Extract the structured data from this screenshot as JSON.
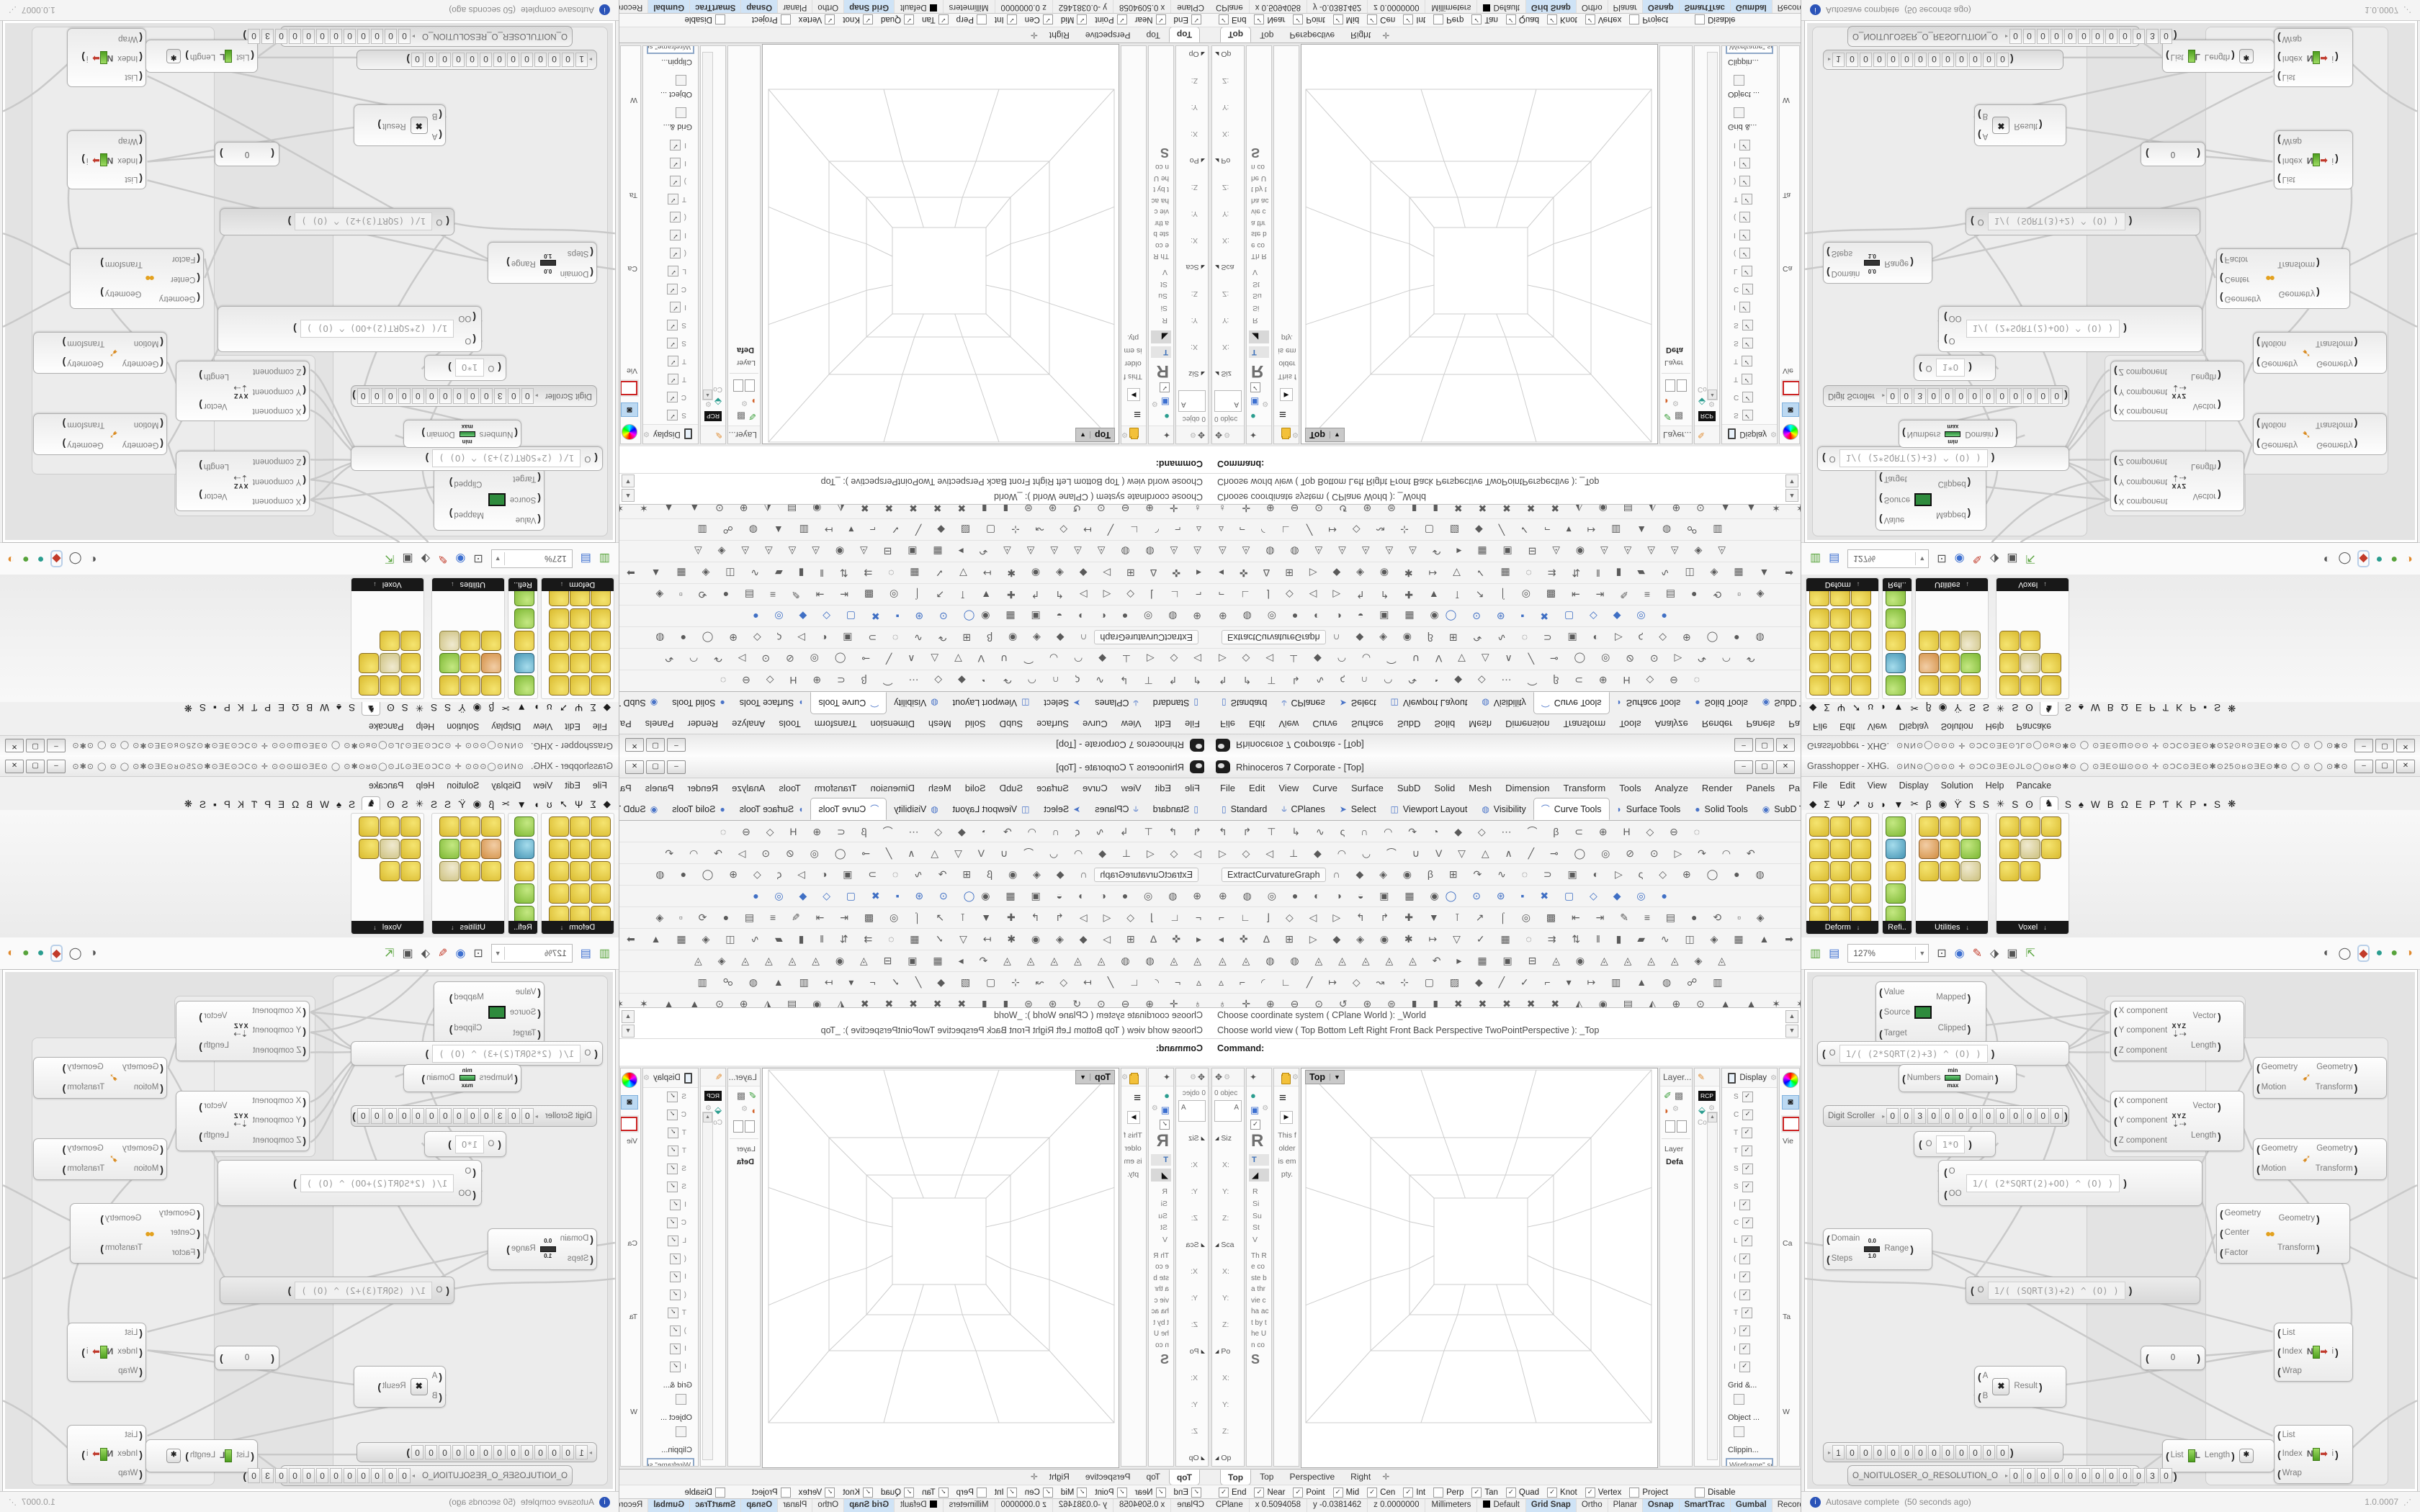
{
  "window": {
    "minimize": "–",
    "maximize": "▢",
    "close": "✕"
  },
  "rhino": {
    "title": "Rhinoceros 7 Corporate - [Top]",
    "menu": [
      "File",
      "Edit",
      "View",
      "Curve",
      "Surface",
      "SubD",
      "Solid",
      "Mesh",
      "Dimension",
      "Transform",
      "Tools",
      "Analyze",
      "Render",
      "Panels",
      "Paneling Tools",
      "Help"
    ],
    "toolbar_tabs": [
      {
        "icon": "▯",
        "label": "Standard",
        "active": false
      },
      {
        "icon": "⫝",
        "label": "CPlanes",
        "active": false
      },
      {
        "icon": "➤",
        "label": "Select",
        "active": false
      },
      {
        "icon": "◫",
        "label": "Viewport Layout",
        "active": false
      },
      {
        "icon": "◍",
        "label": "Visibility",
        "active": false
      },
      {
        "icon": "⌒",
        "label": "Curve Tools",
        "active": true
      },
      {
        "icon": "◗",
        "label": "Surface Tools",
        "active": false
      },
      {
        "icon": "●",
        "label": "Solid Tools",
        "active": false
      },
      {
        "icon": "◉",
        "label": "SubD Too",
        "active": false
      }
    ],
    "toolbar_overflow": "»",
    "toolbar_gear": "⚙",
    "extract_button": "ExtractCurvatureGraph",
    "toolbar_rows": {
      "r1": "↰ ↱ ⊤ ↳ ∿ ς ∩ ◠ ↷ ◔ ◆ ◇ ⋯ ⌒ β ⊂ ⊕ H ◇ ⊖ ◌",
      "r2": "▷ ◇ ◁ ⊥ ◆ ◠ ◡ ⌒ ∪ V ▽ △ ∧ ╱ ⊸ ◯ ◎ ⊘ ⊙ ▷ ↷ ◠ ↶",
      "r3": "∩ ◆ ◈ ◉ β ⊞ ↷ ∿ ◌ ⊃ ▣ ◐ ▷ ς ◇ ⊕ ◯ ● ◍",
      "r4a": "⊕ ◍ ◎ ● ◐ ◑ ◒ ▣ ▦ ◉",
      "r4b": "◯ ⊙ ⊛ ▪ ✖ ▢ ◇ ◆ ◎ ●",
      "r5": "⌐ ∟ ⌋ ◇ ◁ ▷ ↰ ↱ ✚ ▼ ⊺ ↗ ⌠ ◎ ▩ ⇤ ⇥ ✎ ≡ ▤ ● ⟲ ▫ ◈",
      "r6": "◂ ✜ Δ ⊞ ▷ ◆ ◈ ◉ ✱ ↦ ▽ ✓ ▦ ◌ ⇉ ⇅ ‖ ▮ ▰ ∿ ◫ ◈ ▦ ▲ ➡",
      "r7": "◬ ◬ ◍ ◍ ◬ ◬ ◬ ◬ ◬ ↶ ▸ ▦ ▣ ⊟ ◬ ◉ ◬ ◬ ◬ ◬ ◈ ◬",
      "r8": "▵ ⌐ ◜ ∟ ╱ ↦ ◇ ↝ ⊹ ▢ ▨ ◆ ╱ ✓ ⌐ ▾ ↦ ▥ ▲ ◍ ☍ ▥",
      "nav": "♁ ✛ ⊕ ⊖ ⊙ ↺ ⊛ ⊜ ▮ ▮ ✖ ✖ ✖ ✖ ✖ ◭ ◉ ▤ ◭ ⊕ ⊙ ▲ ▲ ✶ ✶ ◇ ◇ ↻ ✜ ✳ ◎"
    },
    "command_history": [
      "Choose coordinate system ( CPlane  World ): _World",
      "Choose world view ( Top  Bottom  Left  Right  Front  Back  Perspective  TwoPointPerspective ): _Top"
    ],
    "command_prompt": "Command:",
    "left_panels": {
      "boxedit_header": "0 objec",
      "boxedit_field": "A",
      "boxedit_rows": [
        {
          "t": "Siz",
          "h": true
        },
        {
          "t": "X:"
        },
        {
          "t": "Y:"
        },
        {
          "t": "Z:"
        },
        {
          "t": "Sca",
          "h": true
        },
        {
          "t": "X:"
        },
        {
          "t": "Y:"
        },
        {
          "t": "Z:"
        },
        {
          "t": "Po",
          "h": true
        },
        {
          "t": "X:"
        },
        {
          "t": "Y:"
        },
        {
          "t": "Z:"
        },
        {
          "t": "Op",
          "h": true
        },
        {
          "t": "Up",
          "h": true
        }
      ],
      "learn_big": "R",
      "learn_tab": "T",
      "learn_list": [
        "R",
        "Si",
        "Su",
        "St",
        "V"
      ],
      "learn_para": "Th Re co ste ba thr vie cha act by the Un co",
      "learn_heading": "S",
      "folder_empty": "This folder is empty."
    },
    "viewport_label": "Top",
    "viewport_tabs": [
      {
        "label": "Top",
        "active": true
      },
      {
        "label": "Top",
        "active": false
      },
      {
        "label": "Perspective",
        "active": false
      },
      {
        "label": "Right",
        "active": false
      }
    ],
    "viewport_add_tab": "✛",
    "right_panels": {
      "layer_tab": "Layer...",
      "layer_label": "Layer",
      "layer_value": "Defa",
      "rcp": "RCP",
      "co_label": "Co",
      "display_tab": "Display",
      "display_rows": [
        {
          "l": "S",
          "on": true
        },
        {
          "l": "C",
          "on": true
        },
        {
          "l": "T",
          "on": true
        },
        {
          "l": "T",
          "on": true
        },
        {
          "l": "S",
          "on": true
        },
        {
          "l": "S",
          "on": true
        },
        {
          "l": "I",
          "on": true
        },
        {
          "l": "C",
          "on": true
        },
        {
          "l": "L",
          "on": true
        },
        {
          "l": "(",
          "on": true
        },
        {
          "l": "I",
          "on": true
        },
        {
          "l": "(",
          "on": true
        },
        {
          "l": "T",
          "on": true
        },
        {
          "l": ")",
          "on": true
        },
        {
          "l": "I",
          "on": true
        },
        {
          "l": "I",
          "on": true
        }
      ],
      "grid_hdr": "Grid &...",
      "object_hdr": "Object ...",
      "clip_hdr": "Clippin...",
      "display_dropdown": "Wireframe\" set",
      "vie": "Vie",
      "ca": "Ca",
      "ta": "Ta",
      "wi": "W",
      "op": "Op"
    },
    "osnap": [
      {
        "label": "End",
        "on": true
      },
      {
        "label": "Near",
        "on": true
      },
      {
        "label": "Point",
        "on": true
      },
      {
        "label": "Mid",
        "on": true
      },
      {
        "label": "Cen",
        "on": true
      },
      {
        "label": "Int",
        "on": true
      },
      {
        "label": "Perp",
        "on": false
      },
      {
        "label": "Tan",
        "on": true
      },
      {
        "label": "Quad",
        "on": true
      },
      {
        "label": "Knot",
        "on": true
      },
      {
        "label": "Vertex",
        "on": true
      },
      {
        "label": "Project",
        "on": false
      }
    ],
    "osnap_disable": "Disable",
    "status_cells": [
      "CPlane",
      "x 0.5094058",
      "y -0.0381462",
      "z 0.0000000",
      "Millimeters"
    ],
    "status_layer": "Default",
    "status_toggles": [
      {
        "label": "Grid Snap",
        "on": true
      },
      {
        "label": "Ortho",
        "on": false
      },
      {
        "label": "Planar",
        "on": false
      },
      {
        "label": "Osnap",
        "on": true
      },
      {
        "label": "SmartTrac",
        "on": true
      },
      {
        "label": "Gumbal",
        "on": true
      },
      {
        "label": "Record History",
        "on": false
      },
      {
        "label": "Filter",
        "on": false
      }
    ]
  },
  "gh": {
    "title": "Grasshopper - XHG.",
    "title_glyphs": "⊙ИN⊙◯⊙⊙⊙ ✛ ⊙ƆC⊙ƎE⊙JL⊙◯⊙ʁ⊙✱⊙    ◯    ⊙ƎE⊙Ш⊙⊙⊙ ✛ ⊙ƆC⊙ƎE⊙✱⊙25⊙ʁ⊙ƎE⊙✱⊙    ◯    ⊙    ◯    ⊙✱⊙ƎE⊙ʁ⊙25⊙✱…",
    "menu": [
      "File",
      "Edit",
      "View",
      "Display",
      "Solution",
      "Help",
      "Pancake"
    ],
    "tabs": [
      {
        "g": "◆",
        "active": false
      },
      {
        "g": "Σ",
        "active": false
      },
      {
        "g": "Ψ",
        "active": false
      },
      {
        "g": "➚",
        "active": false
      },
      {
        "g": "ʊ",
        "active": false
      },
      {
        "g": "◗",
        "active": false
      },
      {
        "g": "▼",
        "active": false
      },
      {
        "g": "✂",
        "active": false
      },
      {
        "g": "β",
        "active": false
      },
      {
        "g": "◉",
        "active": false
      },
      {
        "g": "ϔ",
        "active": false
      },
      {
        "g": "S",
        "active": false
      },
      {
        "g": "S",
        "active": false
      },
      {
        "g": "✳",
        "active": false
      },
      {
        "g": "S",
        "active": false
      },
      {
        "g": "ʘ",
        "active": false
      },
      {
        "g": "♞",
        "active": true
      },
      {
        "g": "S",
        "active": false
      },
      {
        "g": "♠",
        "active": false
      },
      {
        "g": "W",
        "active": false
      },
      {
        "g": "B",
        "active": false
      },
      {
        "g": "Ω",
        "active": false
      },
      {
        "g": "E",
        "active": false
      },
      {
        "g": "P",
        "active": false
      },
      {
        "g": "Ƭ",
        "active": false
      },
      {
        "g": "K",
        "active": false
      },
      {
        "g": "P",
        "active": false
      },
      {
        "g": "▪",
        "active": false
      },
      {
        "g": "S",
        "active": false
      },
      {
        "g": "❋",
        "active": false
      }
    ],
    "ribbon": {
      "deform": {
        "label": "Deform",
        "cells": [
          "y",
          "y",
          "y",
          "y",
          "y",
          "y",
          "y",
          "y",
          "y",
          "y",
          "y",
          "y",
          "y",
          "y",
          "y"
        ]
      },
      "refine": {
        "label": "Refi..",
        "cells": [
          "g",
          "b",
          "y",
          "g",
          "g"
        ]
      },
      "utilities": {
        "label": "Utilities",
        "cells": [
          "y",
          "y",
          "y",
          "p",
          "y",
          "g",
          "y",
          "y",
          "k"
        ]
      },
      "voxel": {
        "label": "Voxel",
        "cells": [
          "y",
          "y",
          "y",
          "y",
          "k",
          "y",
          "y",
          "y"
        ]
      },
      "caption_arrow": "↓"
    },
    "toolbar_zoom": "127%",
    "statusbar": {
      "autosave": "Autosave complete",
      "ago": "(50 seconds ago)",
      "info": "i",
      "version": "1.0.0007",
      "grip": "⋰"
    },
    "nodes": {
      "remap": {
        "inputs": [
          "Value",
          "Source",
          "Target"
        ],
        "outputs": [
          "Mapped",
          "Clipped"
        ]
      },
      "expr1": {
        "var": "O",
        "formula": "1/( (2*SQRT(2)+3) ^ (O) )"
      },
      "bounds": {
        "inputs": [
          "Numbers"
        ],
        "outputs": [
          "Domain"
        ],
        "min": "min",
        "max": "max"
      },
      "scroller1": {
        "label": "Digit Scroller",
        "digits": [
          "0",
          "0",
          "3",
          "0",
          "0",
          "0",
          "0",
          "0",
          "0",
          "0",
          "0",
          "0",
          "0"
        ]
      },
      "exprsmall": {
        "var": "O",
        "formula": "1*O"
      },
      "vector": {
        "inputs": [
          "X component",
          "Y component",
          "Z component"
        ],
        "outputs": [
          "Vector",
          "Length"
        ],
        "icon": "XYZ"
      },
      "move": {
        "inputs": [
          "Geometry",
          "Motion"
        ],
        "outputs": [
          "Geometry",
          "Transform"
        ],
        "icon": "➹"
      },
      "expr2": {
        "var1": "O",
        "var2": "OO",
        "formula": "1/( (2*SQRT(2)+OO) ^ (O) )"
      },
      "range": {
        "inputs": [
          "Domain",
          "Steps"
        ],
        "outputs": [
          "Range"
        ],
        "min": "0.0",
        "max": "1.0"
      },
      "scale": {
        "inputs": [
          "Geometry",
          "Center",
          "Factor"
        ],
        "outputs": [
          "Geometry",
          "Transform"
        ],
        "icon": "●●"
      },
      "expr3": {
        "var": "O",
        "formula": "1/( (SQRT(3)+2) ^ (O) )"
      },
      "mult": {
        "inputs": [
          "A",
          "B"
        ],
        "outputs": [
          "Result"
        ],
        "icon": "✖"
      },
      "panel0": {
        "value": "0"
      },
      "listitem": {
        "inputs": [
          "List",
          "Index",
          "Wrap"
        ],
        "outputs": [
          "i"
        ],
        "n": "N"
      },
      "listlen": {
        "inputs": [
          "List"
        ],
        "outputs": [
          "Length"
        ],
        "l": "L",
        "star": "✱"
      },
      "scroller2": {
        "digits": [
          "1",
          "0",
          "0",
          "0",
          "0",
          "0",
          "0",
          "0",
          "0",
          "0",
          "0",
          "0",
          "0"
        ]
      },
      "scroller3": {
        "label": "O_NOITULOSER_O_RESOLUTION_O",
        "digits": [
          "0",
          "0",
          "0",
          "0",
          "0",
          "0",
          "0",
          "0",
          "0",
          "0",
          "3",
          "0"
        ]
      }
    }
  }
}
